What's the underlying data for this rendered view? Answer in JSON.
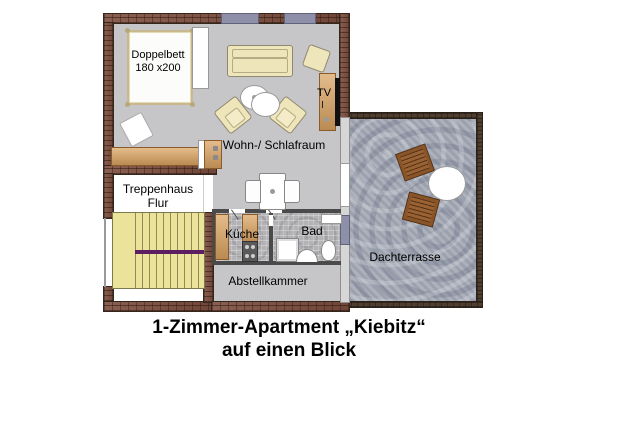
{
  "rooms": {
    "living": {
      "label": "Wohn-/ Schlafraum"
    },
    "bed": {
      "line1": "Doppelbett",
      "line2": "180 x200"
    },
    "tv": {
      "label": "TV"
    },
    "stairwell": {
      "line1": "Treppenhaus",
      "line2": "Flur"
    },
    "kitchen": {
      "label": "Küche"
    },
    "bath": {
      "label": "Bad"
    },
    "storage": {
      "label": "Abstellkammer"
    },
    "terrace": {
      "label": "Dachterrasse"
    }
  },
  "title_caption": {
    "line1": "1-Zimmer-Apartment „Kiebitz“",
    "line2": "auf einen Blick"
  },
  "colors": {
    "wall_brick": "#7b4d3d",
    "terrace_wall": "#4f3e30",
    "floor_gray": "#c6c6c9",
    "tile_gray": "#b3b3b6",
    "stone_blue_gray": "#a7acb8",
    "wood": "#d9a25f",
    "stairs_yellow": "#ece39b",
    "stairs_landing_purple": "#5c1e62",
    "window_slate": "#8d90a8",
    "furniture_beige": "#efe5ba"
  }
}
